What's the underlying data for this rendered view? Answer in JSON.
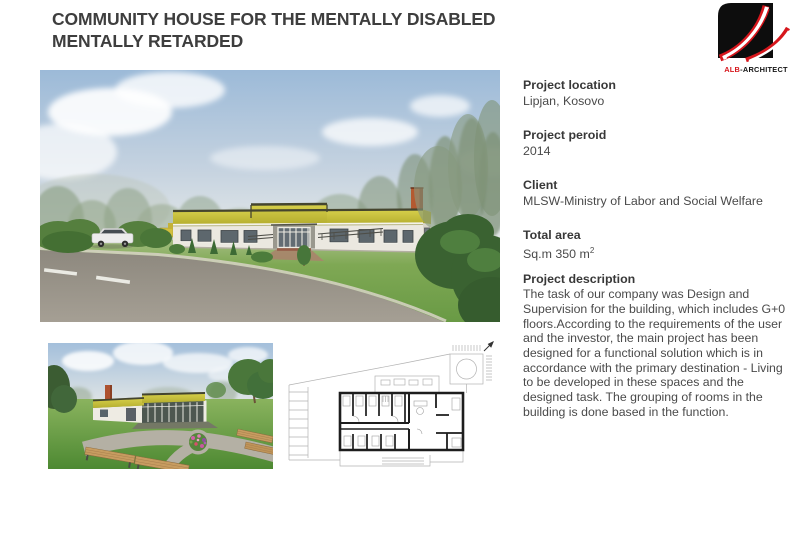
{
  "page": {
    "title_line1": "COMMUNITY HOUSE FOR THE MENTALLY DISABLED",
    "title_line2": "MENTALLY RETARDED"
  },
  "logo": {
    "text_red": "ALB",
    "text_black": "-ARCHITECT"
  },
  "details": {
    "sections": [
      {
        "label": "Project location",
        "value": "Lipjan, Kosovo"
      },
      {
        "label": "Project peroid",
        "value": "2014"
      },
      {
        "label": "Client",
        "value": "MLSW-Ministry of Labor and Social Welfare"
      },
      {
        "label": "Total area",
        "value": "Sq.m 350 m",
        "superscript": "2"
      }
    ],
    "description": {
      "label": "Project description",
      "text": "The task of our company was Design and Supervision for the building, which includes G+0 floors.According to the requirements of the user and the investor, the main project has been designed for a functional solution which is in accordance with the primary destination - Living to be developed in these spaces and the designed task. The grouping of rooms in the building is done based in the function."
    }
  },
  "colors": {
    "brand_red": "#d6161c",
    "title_text": "#3e3e3e",
    "body_text": "#4a4a4a",
    "fascia_yellow": "#c9c23a"
  }
}
